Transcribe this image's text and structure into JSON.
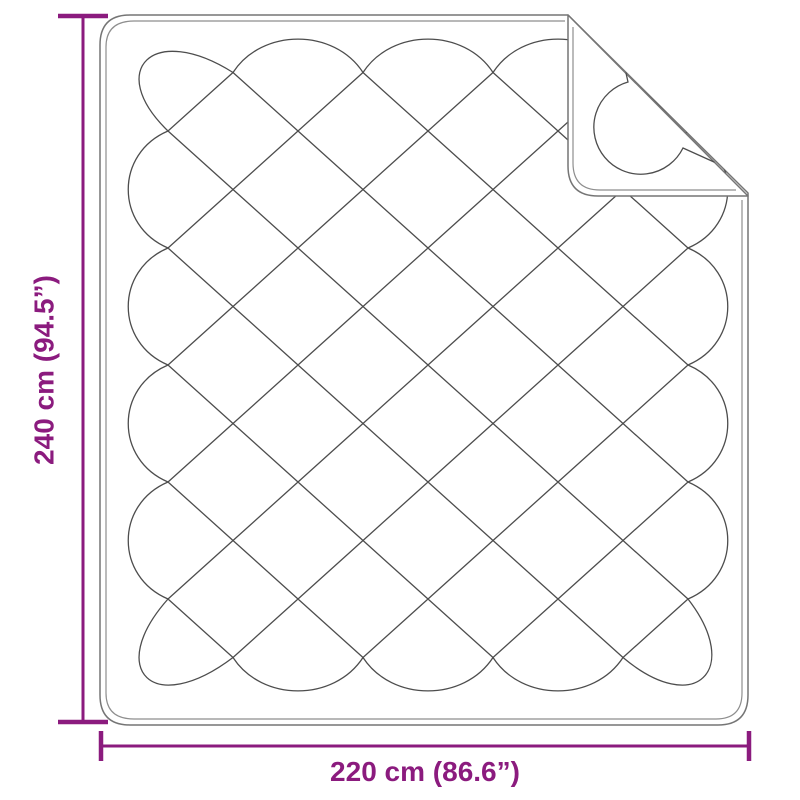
{
  "diagram": {
    "name": "quilted-blanket-dimension-diagram",
    "height_dimension": {
      "label": "240 cm (94.5”)"
    },
    "width_dimension": {
      "label": "220 cm (86.6”)"
    }
  },
  "colors": {
    "dimension_accent": "#8B1B7E",
    "blanket_outline": "#757575",
    "blanket_stitch": "#8E8E8E",
    "quilt_lines": "#4D4D4D",
    "background": "#FFFFFF"
  }
}
